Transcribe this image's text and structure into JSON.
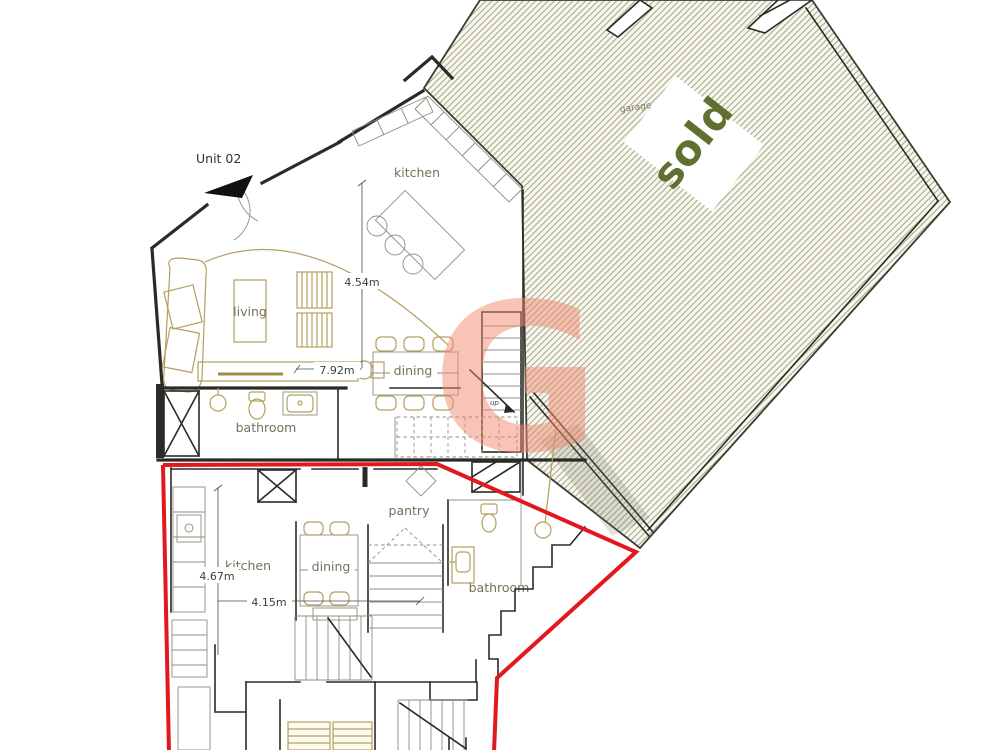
{
  "site": {
    "unit_label": "Unit 02",
    "sold_label": "sold",
    "garage_label": "garage"
  },
  "unit02": {
    "kitchen": "kitchen",
    "living": "living",
    "dining": "dining",
    "bathroom": "bathroom",
    "stair_label": "up",
    "dim_height": "4.54m",
    "dim_width": "7.92m"
  },
  "unit01": {
    "kitchen": "kitchen",
    "dining": "dining",
    "pantry": "pantry",
    "bathroom": "bathroom",
    "dim_height": "4.67m",
    "dim_width": "4.15m"
  },
  "watermark": {
    "letter": "G"
  },
  "colors": {
    "boundary_red": "#e0191f",
    "sold_green": "#5f7030",
    "hatch_line": "#a9a98f",
    "furniture_tan": "#b3a05f",
    "watermark_pink": "#f08a72",
    "wall_black": "#2a2a26",
    "label_olive": "#72725c"
  }
}
